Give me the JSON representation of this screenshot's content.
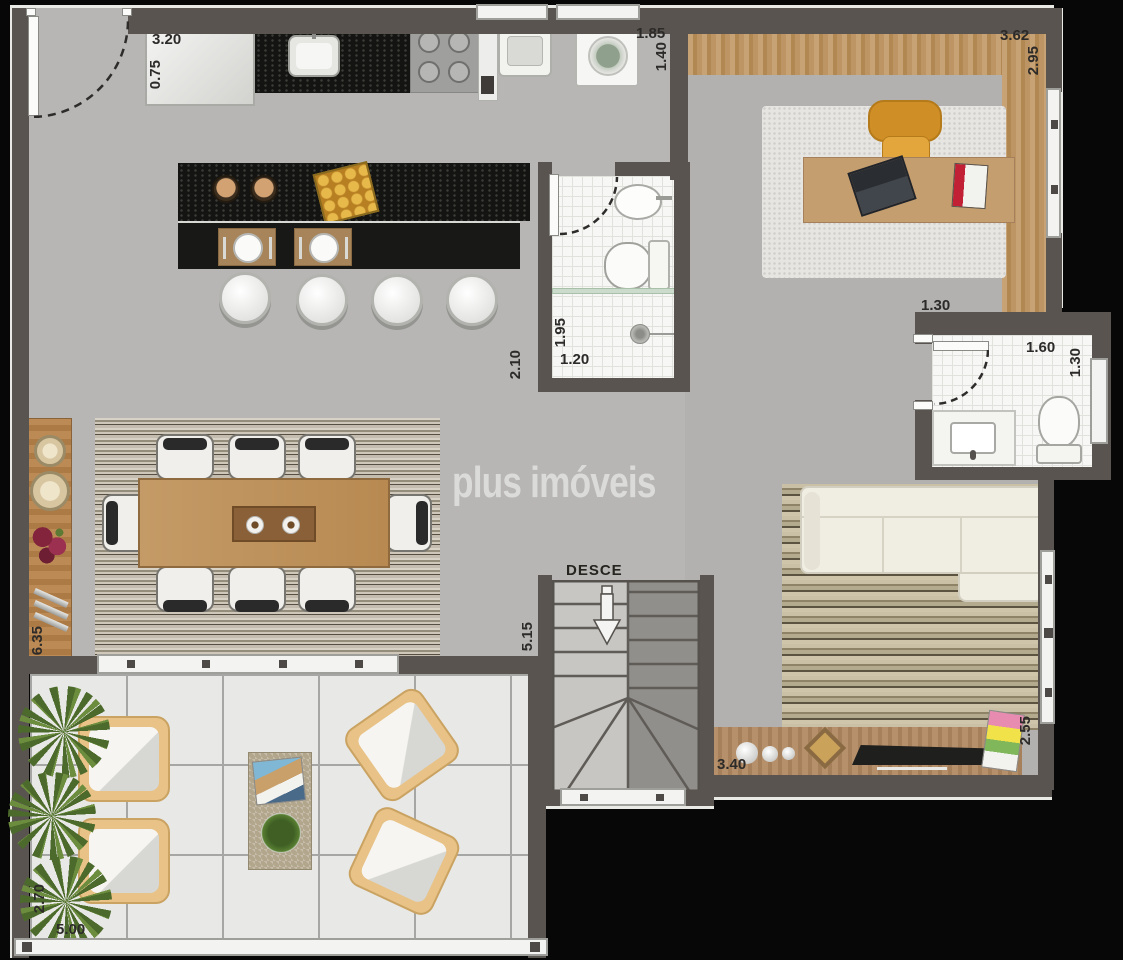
{
  "watermark": "plus imóveis",
  "stairs_label": "DESCE",
  "dims": {
    "kitchen_cabinet_w": "3.20",
    "kitchen_cabinet_d": "0.75",
    "laundry_w": "1.85",
    "laundry_d": "1.40",
    "office_w": "3.62",
    "office_d": "2.95",
    "bath_side": "2.10",
    "bath_inner_d": "1.95",
    "bath_inner_w": "1.20",
    "lavabo_outer_w": "1.30",
    "lavabo_w": "1.60",
    "lavabo_d": "1.30",
    "sideboard_l": "6.35",
    "stairs_l": "5.15",
    "tv_rack_w": "3.40",
    "living_d": "2.55",
    "terrace_d": "2.70",
    "terrace_w": "5.00"
  },
  "palette": {
    "wall": "#59544f",
    "floor": "#b7b6b4",
    "wood": "#b98d5f",
    "granite": "#141412",
    "tile": "#f7f7f5",
    "office_chair": "#d08f26"
  }
}
